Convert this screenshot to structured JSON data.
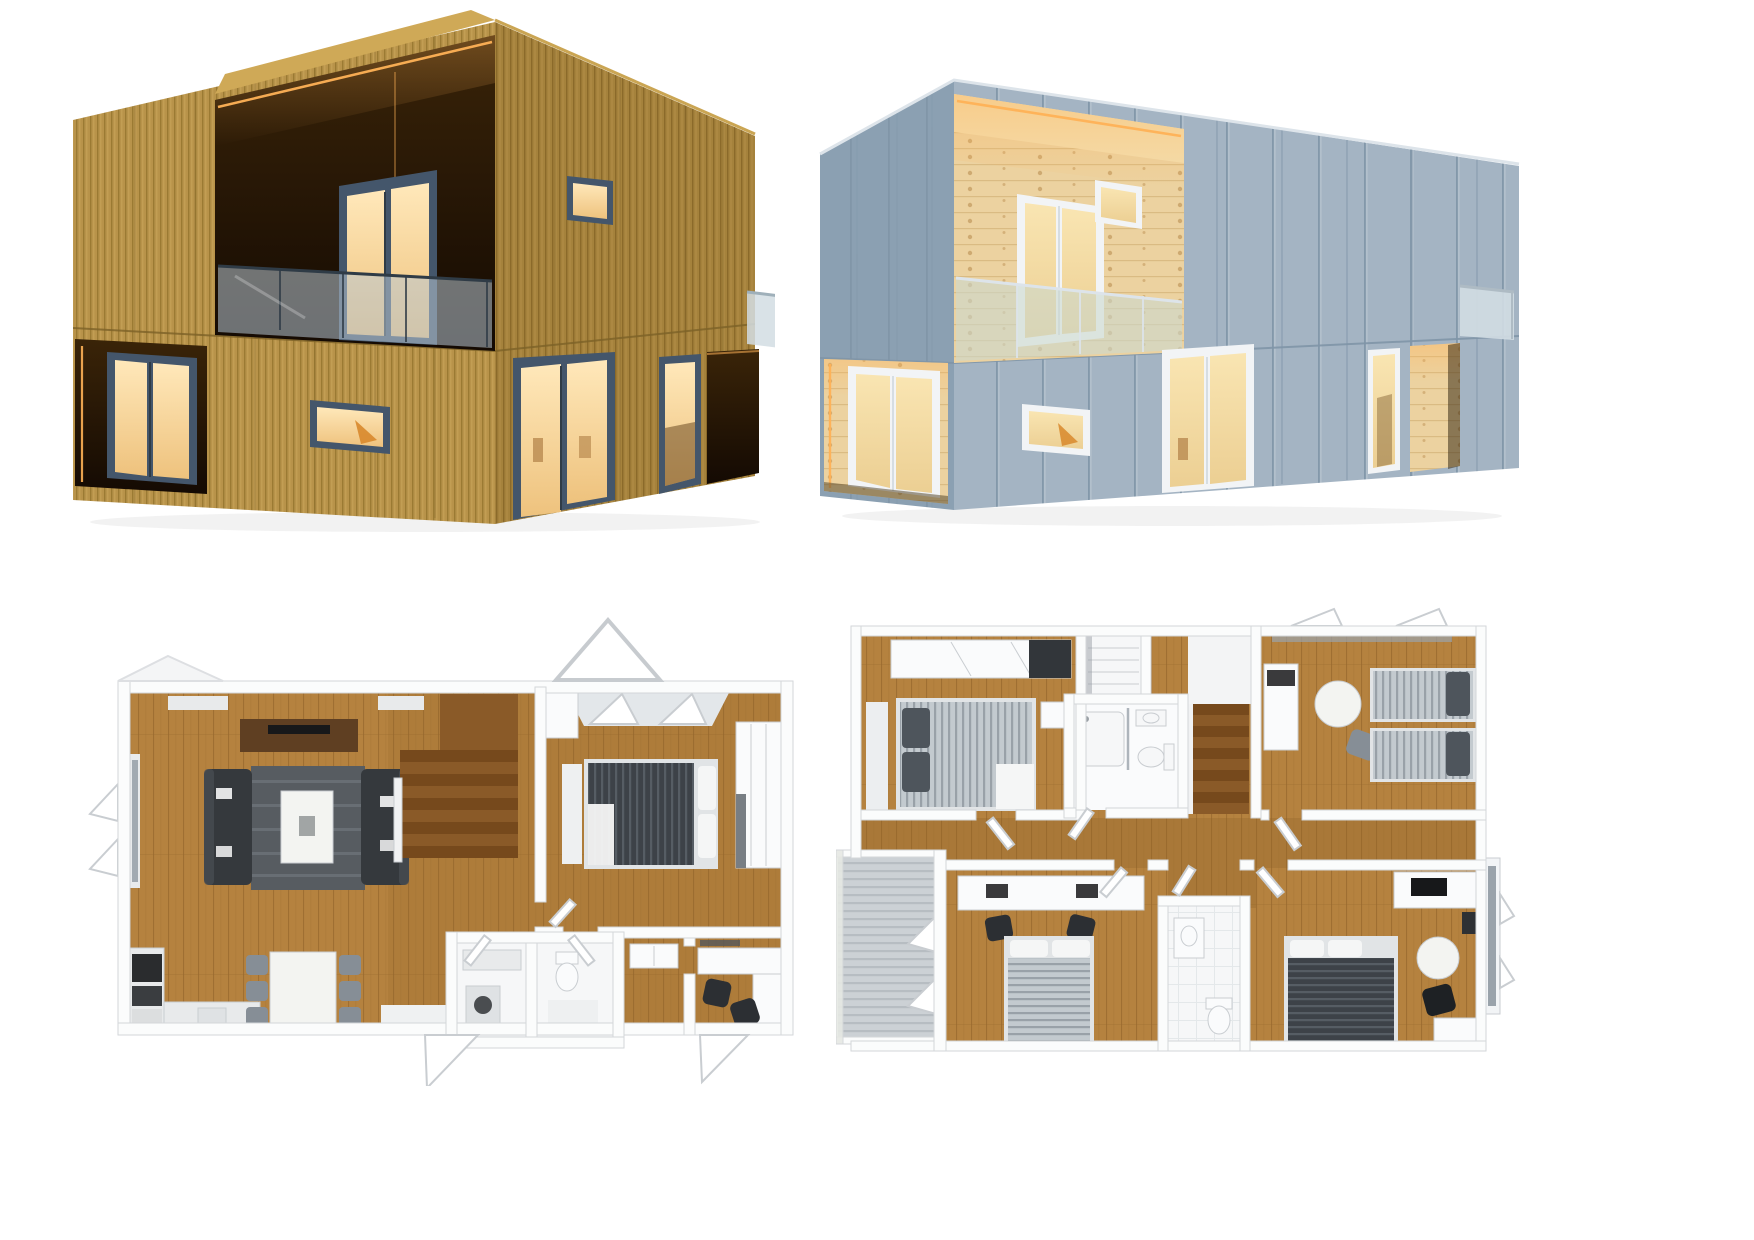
{
  "page": {
    "background": "#ffffff"
  },
  "palette": {
    "wood_base": "#b8934a",
    "wood_stripe": "#97762f",
    "wood_light": "#d4b266",
    "wood_side": "#a5823c",
    "wood_side_stripe": "#866627",
    "roof_wood": "#cfa957",
    "seam_wood": "#7d6228",
    "recess_dark_top": "#3a2408",
    "recess_dark_bottom": "#140a03",
    "led_warm": "#ffb257",
    "frame_slate": "#44566b",
    "glass_warm_hi": "#ffe8ba",
    "glass_warm_lo": "#eec27d",
    "balcony_glass": "#b8c7d2",
    "rail_dark": "#2f3b46",
    "gray_front": "#a4b4c3",
    "gray_seam": "#8095a8",
    "gray_side": "#8ba0b2",
    "edge_light": "#dde4ea",
    "pine_base": "#ecd2a0",
    "pine_line": "#d4b176",
    "pine_knot": "#bb8f52",
    "pine_ceiling": "#f3deae",
    "frame_white": "#f2f4f6",
    "fixture_edge": "#c9cdd1",
    "glass_warm2_hi": "#f9e5b2",
    "glass_warm2_lo": "#eccf93",
    "glass_cool": "#d2dde3",
    "glass_green": "#ccd8cf",
    "glass_pane": "#9aa3ab",
    "plan_wall": "#fbfcfc",
    "plan_wall_edge": "#d3d6d9",
    "plan_floor": "#b5823f",
    "plan_floor_line": "#9a6a2e",
    "plan_floor_hall": "#8f6227",
    "plan_white_floor": "#f6f7f8",
    "tile_line": "#e4e8ea",
    "sofa": "#35393d",
    "sofa_hi": "#4a4f54",
    "rug": "#575c61",
    "rug_line": "#7a8087",
    "table_white": "#f3f4f1",
    "tv_console": "#5f3f22",
    "tv_black": "#17181a",
    "stair_light": "#8a5a28",
    "stair_dark": "#76491c",
    "rail_white": "#f1f2f3",
    "duvet_dark": "#3d4248",
    "duvet_dark_line": "#565d64",
    "duvet_gray": "#c3cacf",
    "duvet_gray_line": "#99a1a8",
    "pillow_dark": "#4e555c",
    "mattress": "#e1e4e6",
    "linen_white": "#f5f6f6",
    "chair_gray": "#868e96",
    "chair_dark": "#2c2f33",
    "appliance_dark": "#2a2c2e",
    "counter": "#e8eaeb",
    "fixture_white": "#fafbfc",
    "deck": "#ccd1d5",
    "deck_line": "#b7bdc2"
  },
  "panels": {
    "timber_house": {
      "label": "Two-storey modular house, vertical timber cladding, recessed balcony with glass balustrade, warm LED cove lighting, slate-blue framed French doors and windows",
      "features": [
        "recessed first-floor balcony",
        "glass balustrade",
        "LED cove lighting",
        "French doors",
        "small horizontal window",
        "recessed entrance",
        "side glass parapet"
      ]
    },
    "gray_house": {
      "label": "Same modular house with grey standing-seam cladding, pine-lined recesses, white window frames and warm interior lighting",
      "features": [
        "pine-lined balcony recess",
        "glass balustrade",
        "LED cove lighting",
        "white French doors",
        "small horizontal window",
        "pine-lined entrance",
        "side glass parapet"
      ]
    },
    "ground_floor_plan": {
      "label": "3D top-down ground floor plan: open living room with two sofas, rug and coffee table, TV console, timber staircase, double bedroom with roof windows and wardrobe, kitchen, dining table with six chairs, bathroom and utility block, hallway and study with desks",
      "rooms": [
        "living room",
        "staircase",
        "bedroom",
        "kitchen",
        "dining area",
        "bathroom",
        "utility WC",
        "entrance hall",
        "study"
      ]
    },
    "upper_floor_plan": {
      "label": "3D top-down upper floor plan: four bedrooms, central bathroom with shower and WC, landing staircase, second shower room, desks, and side balcony with decking",
      "rooms": [
        "bedroom 1",
        "wardrobe closet",
        "bathroom",
        "landing / staircase",
        "bedroom 2",
        "balcony",
        "bedroom 3",
        "shower room",
        "bedroom 4"
      ]
    }
  }
}
